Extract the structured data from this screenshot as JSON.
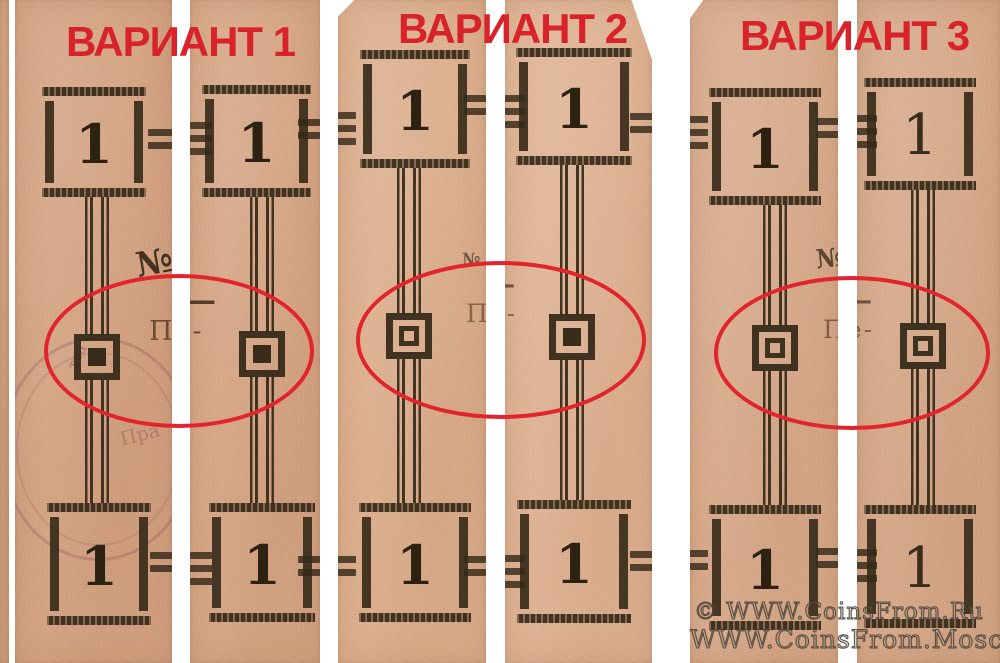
{
  "colors": {
    "background": "#ffffff",
    "paper": "#d8a98a",
    "ink": "#352918",
    "title_red": "#d8232b",
    "ellipse_red": "#e2242c",
    "stamp_violet": "#96555c",
    "watermark_outline": "#484036"
  },
  "variants": [
    {
      "id": 1,
      "title": "ВАРИАНТ 1",
      "fragments": {
        "numero": "№",
        "dash": "—",
        "partial_word": "Пе-"
      },
      "strips": [
        {
          "name": "left",
          "top_value": "1",
          "bottom_value": "1",
          "ornament": "filled"
        },
        {
          "name": "right",
          "top_value": "1",
          "bottom_value": "1",
          "ornament": "filled"
        }
      ]
    },
    {
      "id": 2,
      "title": "ВАРИАНТ 2",
      "fragments": {
        "numero": "№",
        "dash": "—",
        "partial_word": "Пе-"
      },
      "strips": [
        {
          "name": "left",
          "top_value": "1",
          "bottom_value": "1",
          "ornament": "hollow"
        },
        {
          "name": "right",
          "top_value": "1",
          "bottom_value": "1",
          "ornament": "filled"
        }
      ]
    },
    {
      "id": 3,
      "title": "ВАРИАНТ 3",
      "fragments": {
        "numero": "№",
        "dash": "—",
        "partial_word": "Пе-"
      },
      "strips": [
        {
          "name": "left",
          "top_value": "1",
          "bottom_value": "1",
          "ornament": "hollow"
        },
        {
          "name": "right",
          "top_value": "1",
          "bottom_value": "1",
          "ornament": "hollow"
        }
      ]
    }
  ],
  "stamp": {
    "fragment_1": "тва",
    "fragment_2": "Пра"
  },
  "watermark": {
    "line_1": "© WWW.CoinsFrom.Ru",
    "line_2": "WWW.CoinsFrom.Moscow"
  }
}
